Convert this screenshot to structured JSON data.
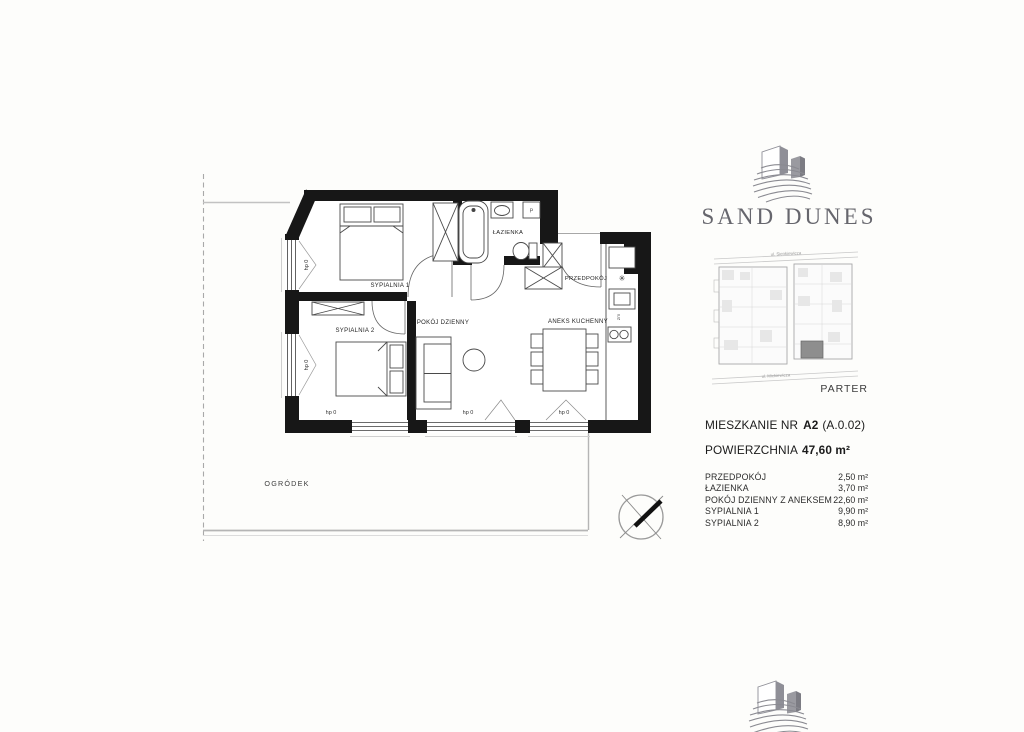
{
  "logo": {
    "brand": "SAND DUNES"
  },
  "site_plan": {
    "street_top": "ul. Sienkiewicza",
    "street_bottom": "ul. Mickiewicza",
    "floor": "PARTER"
  },
  "apartment": {
    "title_label": "MIESZKANIE NR",
    "unit": "A2",
    "unit_code": "(A.0.02)",
    "area_label": "POWIERZCHNIA",
    "area_value": "47,60 m²",
    "rooms": [
      {
        "name": "PRZEDPOKÓJ",
        "area": "2,50 m²"
      },
      {
        "name": "ŁAZIENKA",
        "area": "3,70 m²"
      },
      {
        "name": "POKÓJ DZIENNY Z ANEKSEM",
        "area": "22,60 m²"
      },
      {
        "name": "SYPIALNIA 1",
        "area": "9,90 m²"
      },
      {
        "name": "SYPIALNIA 2",
        "area": "8,90 m²"
      }
    ]
  },
  "plan": {
    "labels": {
      "sypialnia1": "SYPIALNIA 1",
      "sypialnia2": "SYPIALNIA 2",
      "pokoj": "POKÓJ DZIENNY",
      "aneks": "ANEKS KUCHENNY",
      "przedpokoj": "PRZEDPOKÓJ",
      "lazienka": "ŁAZIENKA",
      "ogrodek": "OGRÓDEK"
    },
    "window_label": "hp 0",
    "washer": "P",
    "dishwasher": "zm",
    "fridge_symbol": "✳"
  },
  "colors": {
    "wall": "#171717",
    "logo_gray": "#68686f",
    "highlighted_unit": "#8e8e8e"
  }
}
